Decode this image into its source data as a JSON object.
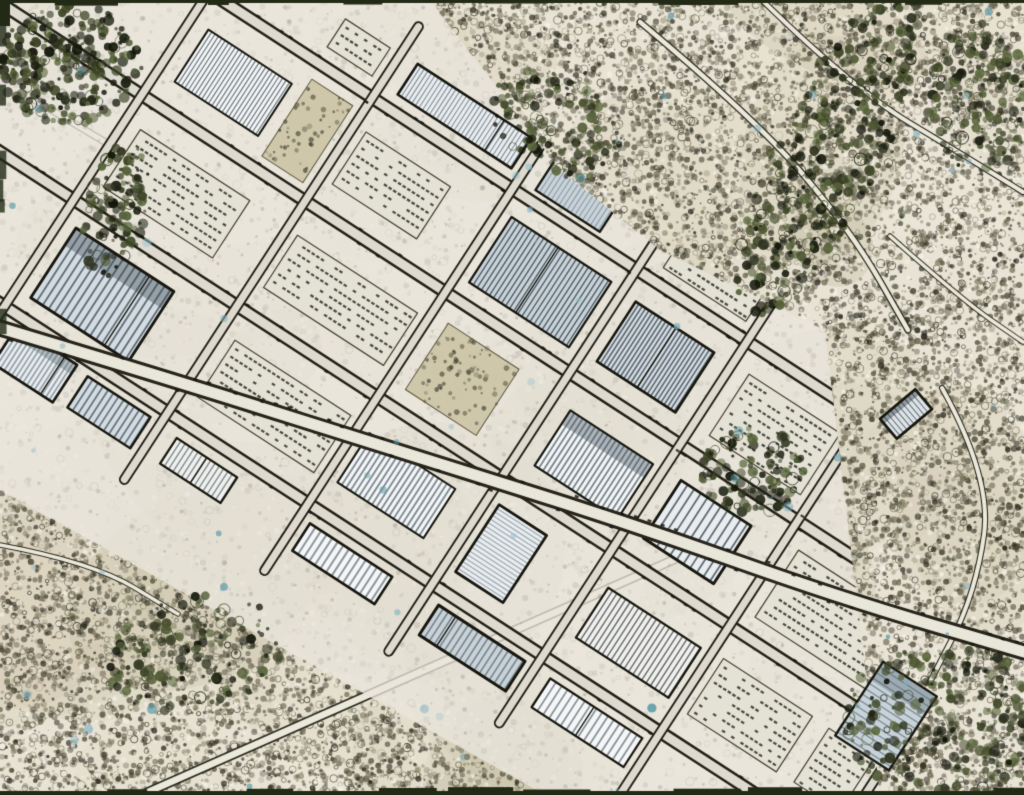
{
  "meta": {
    "alt": "Stylized pen-and-ink aerial view of a diagonal industrial estate surrounded by textured fields and woodland",
    "width": 1024,
    "height": 795
  },
  "scene": {
    "seed": 20240613,
    "palette": {
      "base": "#e8e3d4",
      "washes": [
        "#cfc7ad",
        "#ded7c2",
        "#c2bb9f",
        "#efeadb",
        "#d8d2bd",
        "#b9b296"
      ],
      "stipple": [
        "#3a3a28",
        "#55523c",
        "#6b6750",
        "#23231a",
        "#8a856c",
        "#4a4632",
        "#2e2d20"
      ],
      "speck": "#f7f4ea",
      "road_dark": "#2e2c1f",
      "road_pale": "#ebe8dc",
      "estate_base": "#e9e6dd",
      "street_dark": "#232218",
      "street_pale": "#dedacf",
      "building_fills": [
        "#f4f6f7",
        "#e9edf0",
        "#dde4e9",
        "#d3dce2",
        "#f1f0ec",
        "#c8d2d9"
      ],
      "stripes": [
        "#2e3d48",
        "#46565f",
        "#1f2930",
        "#5d6e78",
        "#3b4750"
      ],
      "building_outline": "#17170f",
      "woodland": [
        "#1d2114",
        "#2f341f",
        "#3e4627",
        "#57643a",
        "#121409",
        "#4c5530"
      ],
      "blue_accents": [
        "#7fb0c0",
        "#5d98a8",
        "#9cc4d0",
        "#3e8f9c"
      ],
      "car": "#15150f",
      "parking_fill": "#e4e1d5",
      "scrub_fill": "#cdc5a8",
      "edge_strip": "#222a16"
    },
    "estate": {
      "angle_deg": 33,
      "center": [
        490,
        395
      ],
      "polygon": [
        [
          0,
          0
        ],
        [
          430,
          0
        ],
        [
          560,
          170
        ],
        [
          660,
          250
        ],
        [
          825,
          330
        ],
        [
          880,
          795
        ],
        [
          545,
          795
        ],
        [
          0,
          490
        ]
      ],
      "street_t": [
        -185,
        -62,
        63,
        190
      ],
      "rows": [
        {
          "t": -122,
          "h": 104
        },
        {
          "t": 2,
          "h": 100
        },
        {
          "t": 127,
          "h": 102
        },
        {
          "t": -220,
          "h": 60
        },
        {
          "t": 222,
          "h": 58
        }
      ],
      "s_min": -660,
      "s_max": 660,
      "cross_min_gap": 130,
      "cross_var": 80
    },
    "spine_road": [
      [
        0,
        328
      ],
      [
        180,
        382
      ],
      [
        400,
        452
      ],
      [
        620,
        520
      ],
      [
        840,
        598
      ],
      [
        1024,
        652
      ]
    ],
    "terrain_roads": [
      {
        "pts": [
          [
            148,
            792
          ],
          [
            430,
            668
          ],
          [
            700,
            548
          ]
        ],
        "w": 6.5
      },
      {
        "pts": [
          [
            640,
            22
          ],
          [
            755,
            118
          ],
          [
            852,
            232
          ],
          [
            908,
            330
          ]
        ],
        "w": 4.5
      },
      {
        "pts": [
          [
            762,
            0
          ],
          [
            852,
            88
          ],
          [
            968,
            158
          ],
          [
            1023,
            192
          ]
        ],
        "w": 4
      },
      {
        "pts": [
          [
            942,
            388
          ],
          [
            992,
            478
          ],
          [
            976,
            592
          ],
          [
            930,
            682
          ]
        ],
        "w": 4
      },
      {
        "pts": [
          [
            28,
            96
          ],
          [
            122,
            152
          ],
          [
            232,
            218
          ]
        ],
        "w": 5
      },
      {
        "pts": [
          [
            0,
            545
          ],
          [
            92,
            562
          ],
          [
            178,
            614
          ]
        ],
        "w": 3.5
      },
      {
        "pts": [
          [
            890,
            236
          ],
          [
            962,
            300
          ],
          [
            1023,
            342
          ]
        ],
        "w": 3.5
      }
    ],
    "woodland_patches": [
      {
        "cx": 70,
        "cy": 64,
        "rx": 72,
        "ry": 60,
        "rot": 0,
        "n": 300
      },
      {
        "cx": 828,
        "cy": 152,
        "rx": 52,
        "ry": 180,
        "rot": 26,
        "n": 430
      },
      {
        "cx": 980,
        "cy": 96,
        "rx": 55,
        "ry": 75,
        "rot": 0,
        "n": 170
      },
      {
        "cx": 962,
        "cy": 728,
        "rx": 120,
        "ry": 82,
        "rot": 8,
        "n": 330
      },
      {
        "cx": 752,
        "cy": 470,
        "rx": 52,
        "ry": 44,
        "rot": 0,
        "n": 120
      },
      {
        "cx": 196,
        "cy": 652,
        "rx": 92,
        "ry": 58,
        "rot": -14,
        "n": 150
      },
      {
        "cx": 116,
        "cy": 210,
        "rx": 30,
        "ry": 70,
        "rot": 12,
        "n": 120
      },
      {
        "cx": 555,
        "cy": 125,
        "rx": 70,
        "ry": 48,
        "rot": 30,
        "n": 110
      }
    ],
    "extra_buildings": [
      {
        "x": 886,
        "y": 716,
        "w": 64,
        "d": 88,
        "rot": 33
      },
      {
        "x": 906,
        "y": 414,
        "w": 46,
        "d": 26,
        "rot": -40
      }
    ],
    "washes": {
      "count": 70
    },
    "stipple": {
      "count": 30000,
      "specks": 2500
    },
    "clusters": {
      "count": 24
    },
    "blue_accents": {
      "count": 60
    },
    "edge_strips": {
      "top_h": 3,
      "bottom_h": 4
    }
  }
}
